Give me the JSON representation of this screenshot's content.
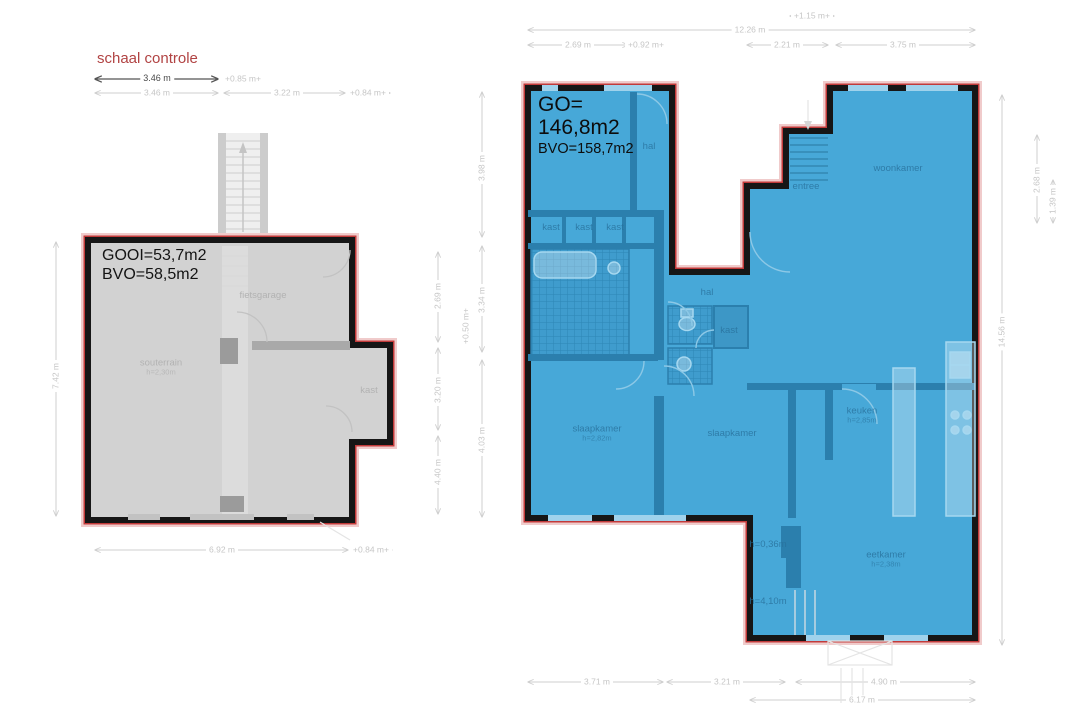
{
  "scale_control": {
    "title": "schaal controle"
  },
  "colors": {
    "highlight_red": "#c23a3a",
    "plan_blue": "#47a8d8",
    "plan_gray": "#d2d2d2",
    "wall_black": "#161616"
  },
  "left_plan": {
    "usable_area": "GOOI=53,7m2",
    "gross_area": "BVO=58,5m2",
    "rooms": [
      {
        "t": "fietsgarage",
        "x": 263,
        "y": 296
      },
      {
        "t": "souterrain",
        "sub": "h=2,30m",
        "x": 161,
        "y": 368
      },
      {
        "t": "kast",
        "x": 369,
        "y": 391
      }
    ]
  },
  "right_plan": {
    "usable_area_label": "GO=",
    "usable_area_value": "146,8m2",
    "gross_area": "BVO=158,7m2",
    "rooms": [
      {
        "t": "hal",
        "x": 649,
        "y": 147
      },
      {
        "t": "entree",
        "x": 806,
        "y": 187
      },
      {
        "t": "woonkamer",
        "x": 898,
        "y": 169
      },
      {
        "t": "kast",
        "x": 551,
        "y": 228
      },
      {
        "t": "kast",
        "x": 584,
        "y": 228
      },
      {
        "t": "kast",
        "x": 615,
        "y": 228
      },
      {
        "t": "hal",
        "x": 707,
        "y": 293
      },
      {
        "t": "kast",
        "x": 729,
        "y": 331
      },
      {
        "t": "slaapkamer",
        "sub": "h=2,82m",
        "x": 597,
        "y": 434
      },
      {
        "t": "slaapkamer",
        "x": 732,
        "y": 434
      },
      {
        "t": "keuken",
        "sub": "h=2,85m",
        "x": 862,
        "y": 416
      },
      {
        "t": "eetkamer",
        "sub": "h=2,38m",
        "x": 886,
        "y": 560
      },
      {
        "t": "h=0,36m",
        "x": 768,
        "y": 545
      },
      {
        "t": "h=4,10m",
        "x": 768,
        "y": 602
      }
    ]
  },
  "dimensions": {
    "scale_check": [
      {
        "t": "3.46 m",
        "x": 157,
        "y": 79
      }
    ],
    "left_plan": [
      {
        "t": "+0.85 m+",
        "x": 243,
        "y": 79
      },
      {
        "t": "3.46 m",
        "x": 157,
        "y": 93
      },
      {
        "t": "3.22 m",
        "x": 287,
        "y": 93
      },
      {
        "t": "+0.84 m+",
        "x": 368,
        "y": 93
      },
      {
        "t": "6.92 m",
        "x": 222,
        "y": 550
      },
      {
        "t": "+0.84 m+",
        "x": 371,
        "y": 550
      },
      {
        "t": "7.42 m",
        "x": 56,
        "y": 376,
        "rot": true
      }
    ],
    "between_plans": [
      {
        "t": "2.69 m",
        "x": 438,
        "y": 296,
        "rot": true
      },
      {
        "t": "3.20 m",
        "x": 438,
        "y": 390,
        "rot": true
      },
      {
        "t": "4.40 m",
        "x": 438,
        "y": 472,
        "rot": true
      },
      {
        "t": "3.98 m",
        "x": 482,
        "y": 168,
        "rot": true
      },
      {
        "t": "3.34 m",
        "x": 482,
        "y": 300,
        "rot": true
      },
      {
        "t": "+0.50 m+",
        "x": 466,
        "y": 326,
        "rot": true
      },
      {
        "t": "4.03 m",
        "x": 482,
        "y": 440,
        "rot": true
      }
    ],
    "right_plan": [
      {
        "t": "+1.15 m+",
        "x": 812,
        "y": 16
      },
      {
        "t": "12.26 m",
        "x": 750,
        "y": 30
      },
      {
        "t": "2.69 m",
        "x": 578,
        "y": 45
      },
      {
        "t": "+0.92 m+",
        "x": 646,
        "y": 45
      },
      {
        "t": "2.21 m",
        "x": 787,
        "y": 45
      },
      {
        "t": "3.75 m",
        "x": 903,
        "y": 45
      },
      {
        "t": "3.71 m",
        "x": 597,
        "y": 682
      },
      {
        "t": "3.21 m",
        "x": 727,
        "y": 682
      },
      {
        "t": "4.90 m",
        "x": 884,
        "y": 682
      },
      {
        "t": "6.17 m",
        "x": 862,
        "y": 700
      },
      {
        "t": "14.56 m",
        "x": 1002,
        "y": 332,
        "rot": true
      },
      {
        "t": "2.68 m",
        "x": 1037,
        "y": 180,
        "rot": true
      },
      {
        "t": "1.39 m",
        "x": 1053,
        "y": 201,
        "rot": true
      }
    ]
  }
}
